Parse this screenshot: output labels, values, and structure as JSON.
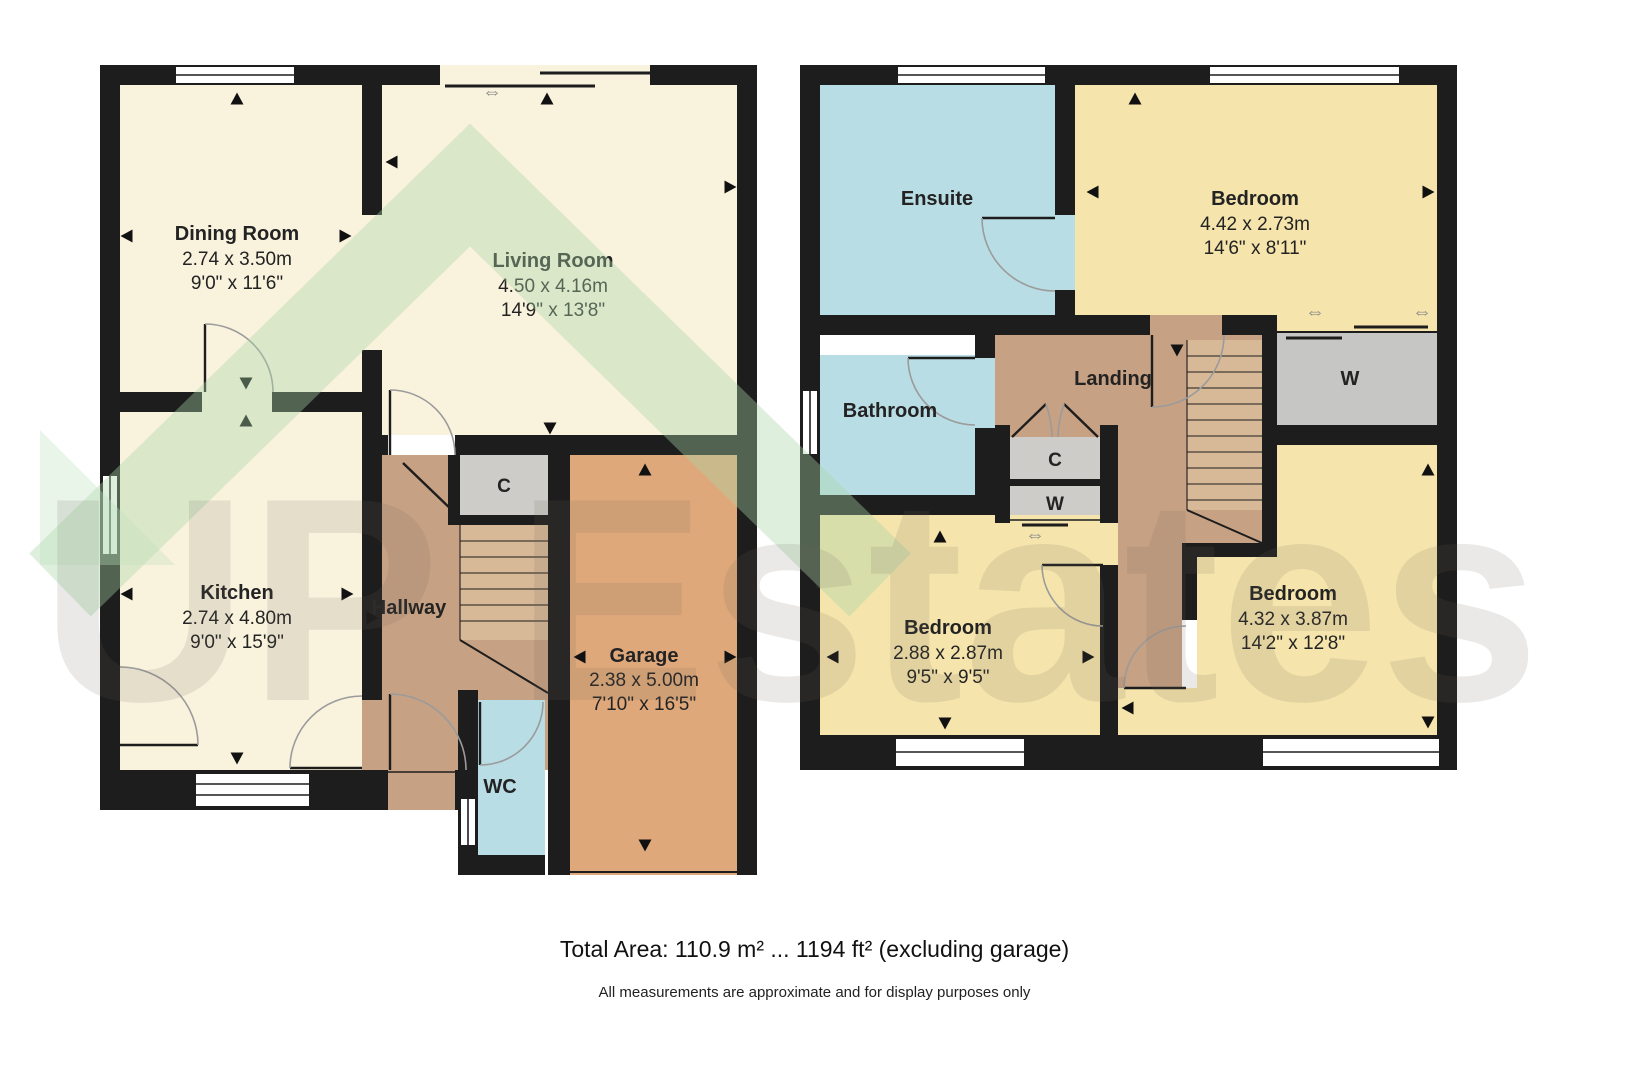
{
  "watermark": {
    "text": "UP Estates"
  },
  "icons": {
    "double_arrow": "⇔"
  },
  "colors": {
    "wall": "#1d1d1d",
    "cream_room": "#f9f2dd",
    "yellow_room": "#f5e4ab",
    "blue_room": "#b9dde4",
    "hall_brown": "#c6a183",
    "stairs_brown": "#d7b897",
    "garage_orange": "#dfa87a",
    "closet_gray": "#cdccc8"
  },
  "ground_floor": {
    "rooms": {
      "dining_room": {
        "name": "Dining Room",
        "metric": "2.74 x 3.50m",
        "imperial": "9'0\" x 11'6\""
      },
      "living_room": {
        "name": "Living Room",
        "metric": "4.50 x 4.16m",
        "imperial": "14'9\" x 13'8\""
      },
      "kitchen": {
        "name": "Kitchen",
        "metric": "2.74 x 4.80m",
        "imperial": "9'0\" x 15'9\""
      },
      "hallway": {
        "name": "Hallway"
      },
      "garage": {
        "name": "Garage",
        "metric": "2.38 x 5.00m",
        "imperial": "7'10\" x 16'5\""
      },
      "wc": {
        "name": "WC"
      },
      "cupboard": {
        "name": "C"
      }
    }
  },
  "first_floor": {
    "rooms": {
      "ensuite": {
        "name": "Ensuite"
      },
      "bedroom_front": {
        "name": "Bedroom",
        "metric": "4.42 x 2.73m",
        "imperial": "14'6\" x 8'11\""
      },
      "bathroom": {
        "name": "Bathroom"
      },
      "landing": {
        "name": "Landing"
      },
      "cupboard": {
        "name": "C"
      },
      "wardrobe_small": {
        "name": "W"
      },
      "wardrobe": {
        "name": "W"
      },
      "bedroom_small": {
        "name": "Bedroom",
        "metric": "2.88 x 2.87m",
        "imperial": "9'5\" x 9'5\""
      },
      "bedroom_rear": {
        "name": "Bedroom",
        "metric": "4.32 x 3.87m",
        "imperial": "14'2\" x 12'8\""
      }
    }
  },
  "footer": {
    "total_area": "Total Area: 110.9 m² ... 1194 ft² (excluding garage)",
    "disclaimer": "All measurements are approximate and for display purposes only"
  }
}
